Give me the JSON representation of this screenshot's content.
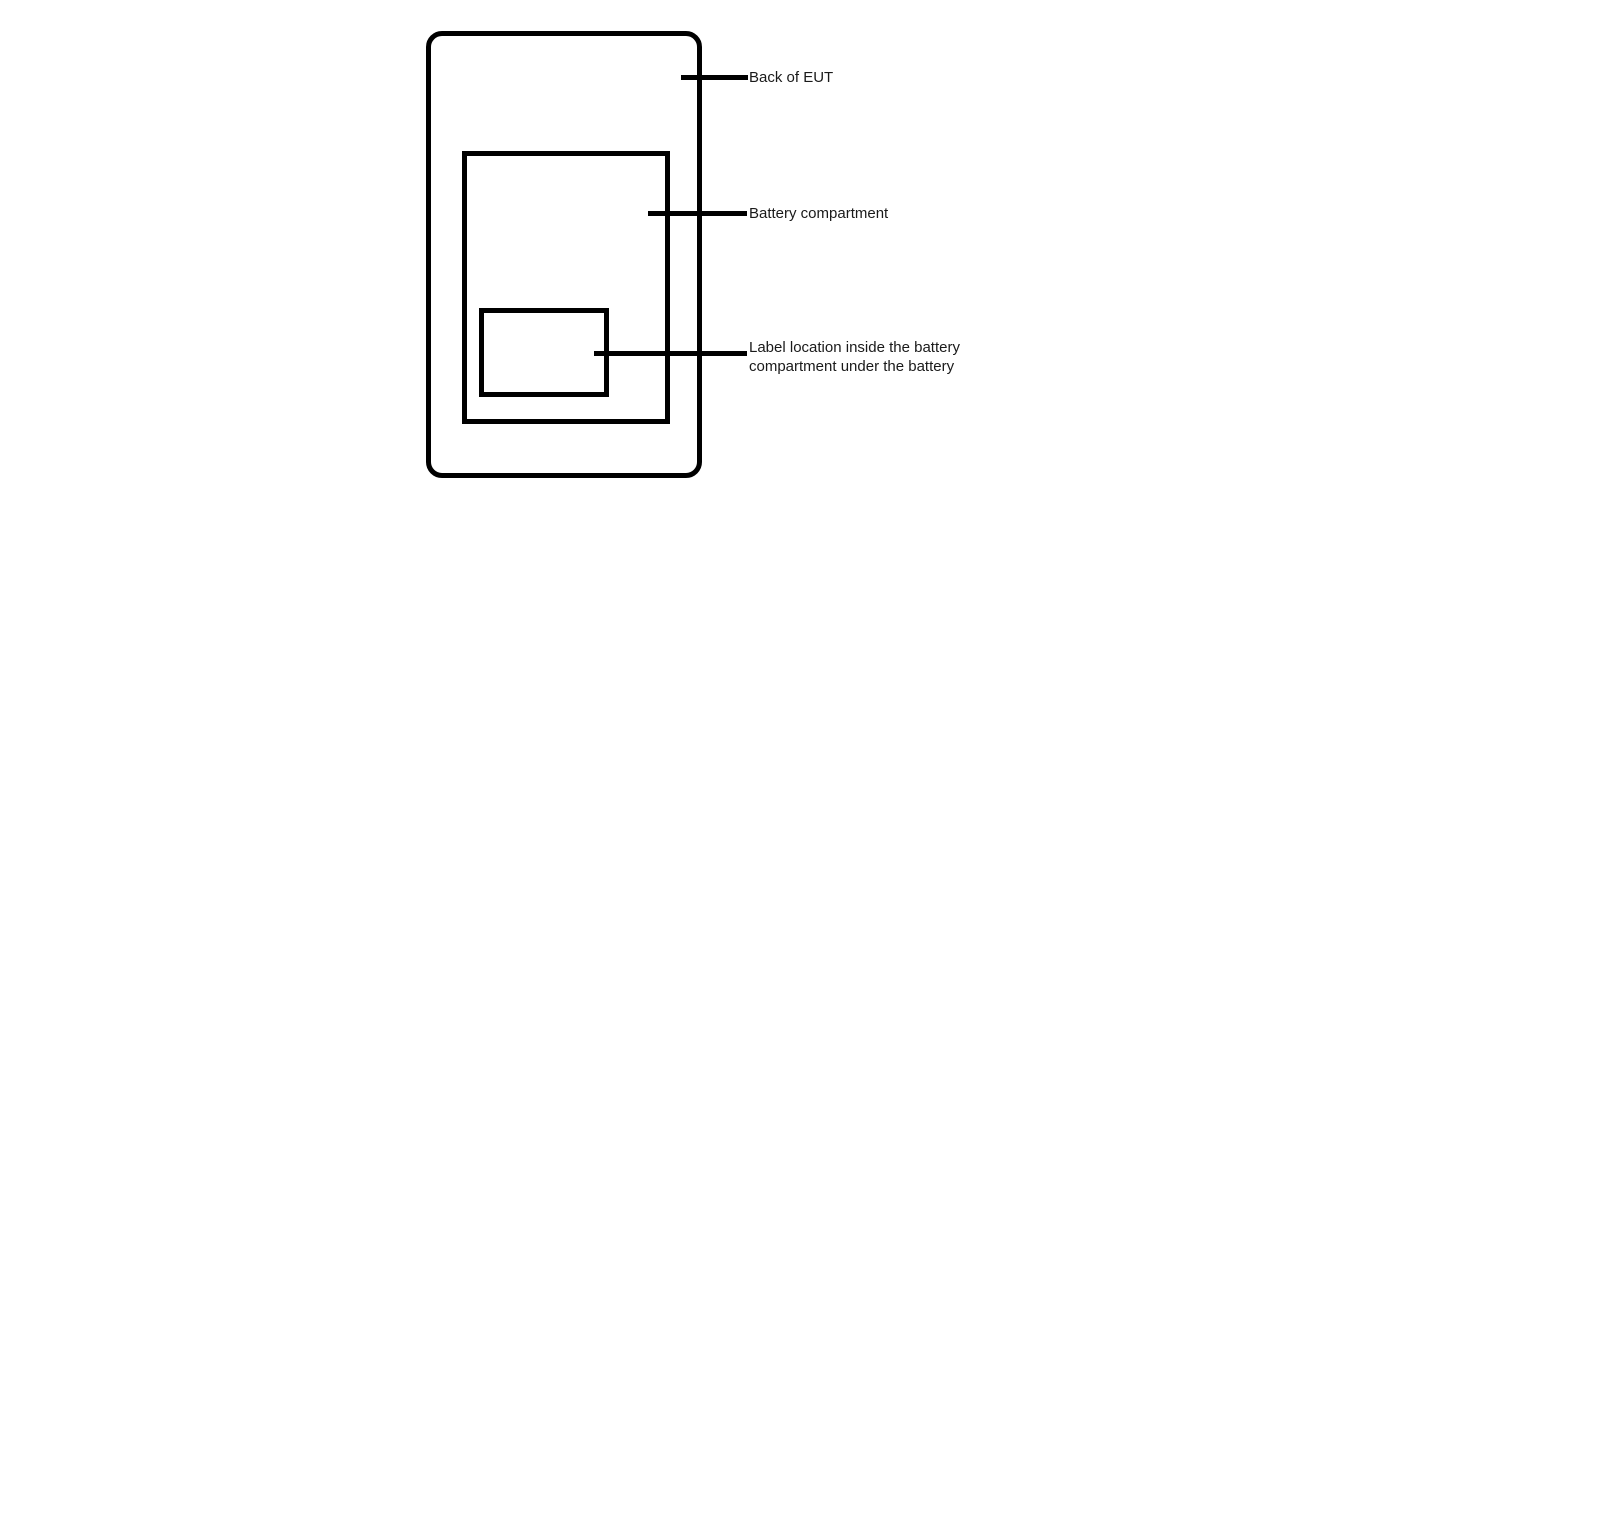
{
  "diagram": {
    "background_color": "#ffffff",
    "line_color": "#000000",
    "text_color": "#1a1a1a",
    "callouts": [
      {
        "label": "Back of EUT"
      },
      {
        "label": "Battery compartment"
      },
      {
        "label_line1": "Label location inside the battery",
        "label_line2": "compartment under the battery"
      }
    ]
  }
}
